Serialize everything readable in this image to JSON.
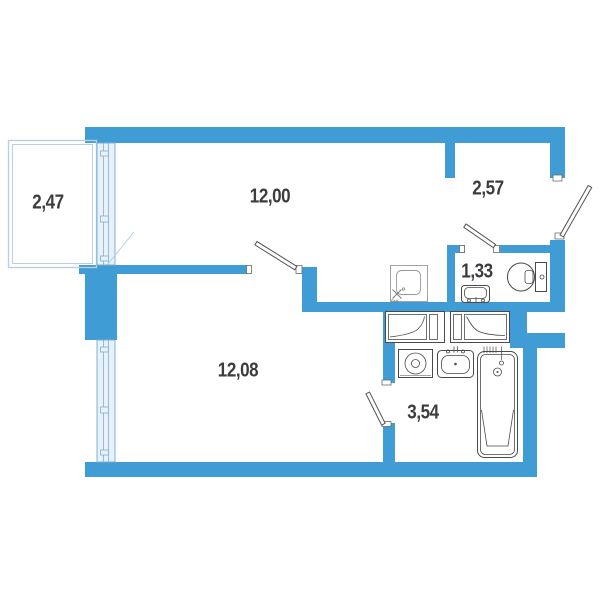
{
  "rooms": [
    {
      "name": "balcony",
      "area": "2,47"
    },
    {
      "name": "living-room",
      "area": "12,00"
    },
    {
      "name": "hallway",
      "area": "2,57"
    },
    {
      "name": "toilet",
      "area": "1,33"
    },
    {
      "name": "bedroom",
      "area": "12,08"
    },
    {
      "name": "bathroom-corridor",
      "area": "3,54"
    }
  ],
  "vent_label": "ВтК",
  "colors": {
    "wall": "#409cd4",
    "window_fill": "#e9f1f8",
    "window_frame": "#7fb0d6",
    "railing": "#b7cfe3",
    "fixture_line": "#4a4a4a",
    "label_text": "#3c3c3c"
  },
  "fixtures": [
    "toilet",
    "wash-basin",
    "ventilation-shaft",
    "wardrobe",
    "wardrobe",
    "washing-machine",
    "wash-basin",
    "bathtub"
  ]
}
